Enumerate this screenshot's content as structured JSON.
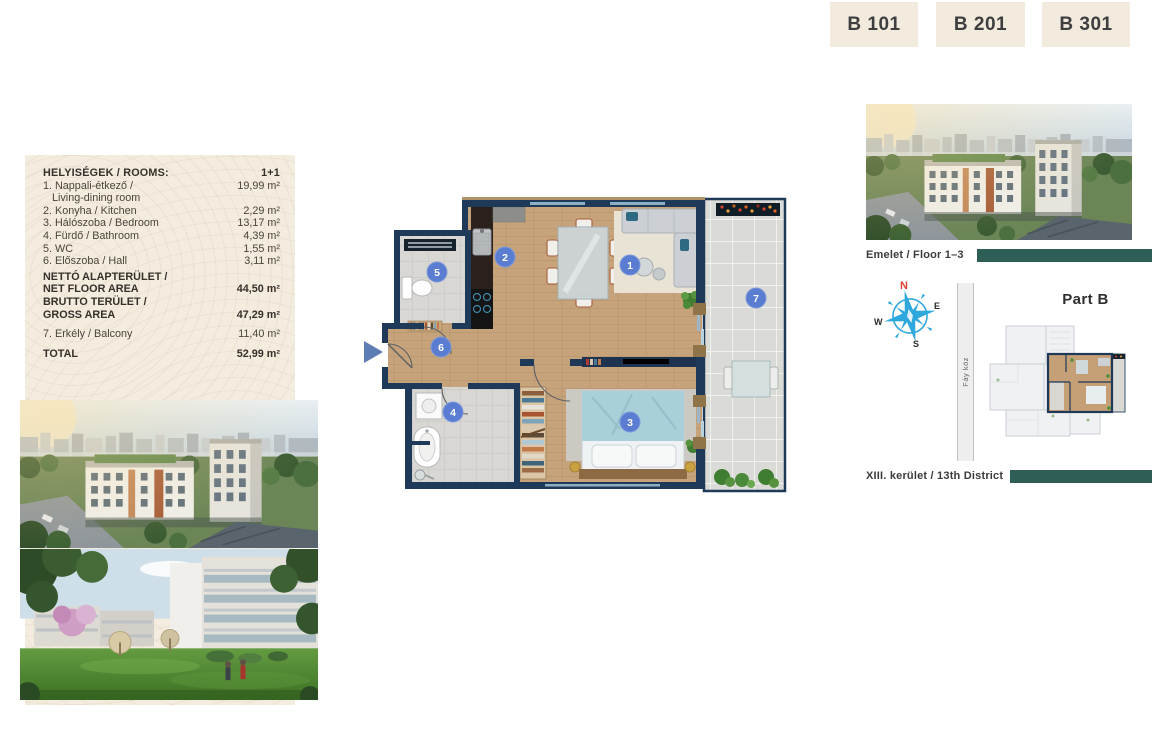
{
  "unit_tabs": [
    {
      "label": "B 101"
    },
    {
      "label": "B 201"
    },
    {
      "label": "B 301"
    }
  ],
  "room_table": {
    "header": {
      "title": "HELYISÉGEK / ROOMS:",
      "type": "1+1"
    },
    "rows": [
      {
        "label": "1. Nappali-étkező /",
        "label2": "Living-dining room",
        "value": "19,99 m²"
      },
      {
        "label": "2. Konyha / Kitchen",
        "value": "2,29 m²"
      },
      {
        "label": "3. Hálószoba / Bedroom",
        "value": "13,17 m²"
      },
      {
        "label": "4. Fürdő / Bathroom",
        "value": "4,39 m²"
      },
      {
        "label": "5. WC",
        "value": "1,55 m²"
      },
      {
        "label": "6. Előszoba / Hall",
        "value": "3,11 m²"
      }
    ],
    "net": {
      "label1": "NETTÓ ALAPTERÜLET /",
      "label2": "NET FLOOR AREA",
      "value": "44,50 m²"
    },
    "gross": {
      "label1": "BRUTTO TERÜLET /",
      "label2": "GROSS AREA",
      "value": "47,29 m²"
    },
    "balcony": {
      "label": "7. Erkély / Balcony",
      "value": "11,40 m²"
    },
    "total": {
      "label": "TOTAL",
      "value": "52,99 m²"
    }
  },
  "floor_plan": {
    "room_numbers": [
      "1",
      "2",
      "3",
      "4",
      "5",
      "6",
      "7"
    ]
  },
  "right_panel": {
    "floor_label": "Emelet / Floor 1–3",
    "part_label": "Part B",
    "street_label": "Fáy köz",
    "district_label": "XIII. kerület / 13th District",
    "compass": {
      "n": "N",
      "e": "E",
      "s": "S",
      "w": "W"
    }
  },
  "colors": {
    "accent_teal": "#2e5e56",
    "panel_beige": "#f3ecdf",
    "tab_beige": "#f1eadd",
    "wall_navy": "#1f3a58",
    "room_number_blue": "#5a7dd2",
    "compass_blue": "#2ea7dc",
    "compass_north_red": "#e03c31",
    "entry_arrow_blue": "#5b7db4"
  }
}
